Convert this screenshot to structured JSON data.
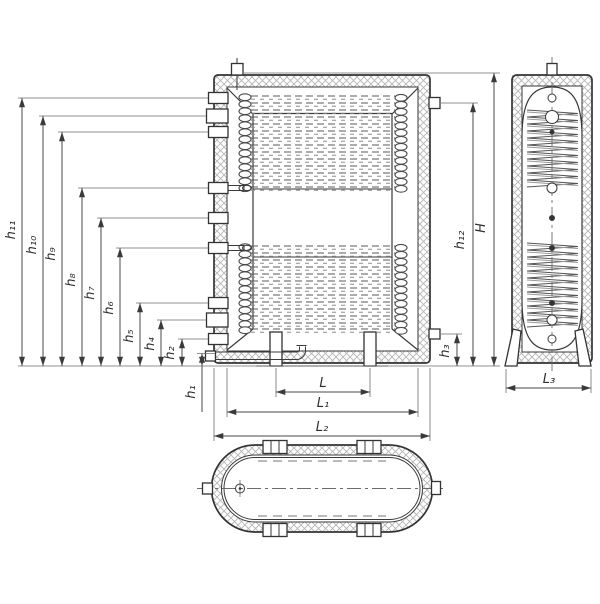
{
  "drawing": {
    "type": "technical-drawing-buffer-tank",
    "labels": {
      "h1": "h₁",
      "h2": "h₂",
      "h3": "h₃",
      "h4": "h₄",
      "h5": "h₅",
      "h6": "h₆",
      "h7": "h₇",
      "h8": "h₈",
      "h9": "h₉",
      "h10": "h₁₀",
      "h11": "h₁₁",
      "h12": "h₁₂",
      "H": "H",
      "L": "L",
      "L1": "L₁",
      "L2": "L₂",
      "L3": "L₃"
    },
    "colors": {
      "line": "#333333",
      "dimension": "#4a4a4a",
      "hatch": "#b5b5b5",
      "background": "#ffffff"
    }
  }
}
